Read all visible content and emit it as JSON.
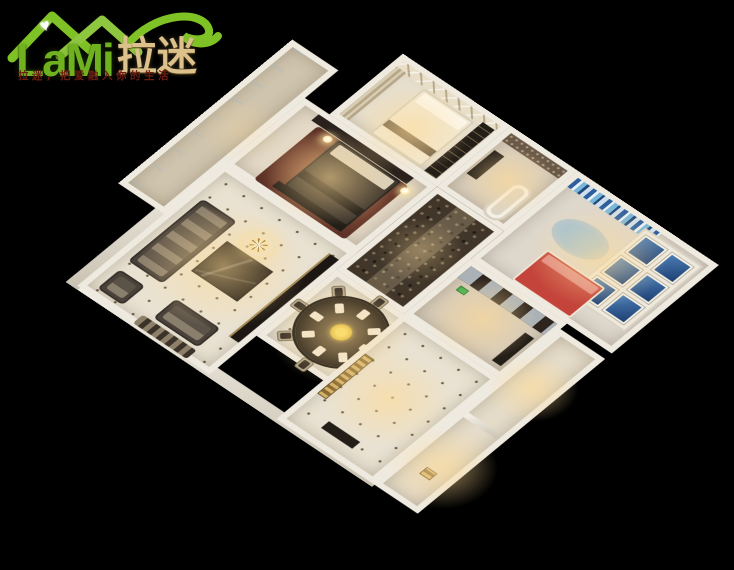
{
  "page": {
    "background_color": "#000000",
    "width": 734,
    "height": 570
  },
  "logo": {
    "brand_latin": "LaMi",
    "brand_cn": "拉迷",
    "tagline": "拉迷，把爱融入你的生活",
    "colors": {
      "roof_green": "#7fc226",
      "brand_green": "#6fb11e",
      "brand_gold": "#dcc18c",
      "tagline_red": "#6e1d14"
    }
  },
  "icons": {
    "heart": "♥"
  },
  "scene": {
    "description": "3D cutaway floor-plan render of a furnished apartment viewed from above on a black background",
    "rooms": [
      "guest-bedroom",
      "master-bedroom",
      "living-room",
      "balcony",
      "bathroom",
      "kids-bedroom",
      "hallway",
      "dining-room",
      "kitchen",
      "foyer",
      "utility-rooms"
    ],
    "palette": {
      "floor_cream": "#e9e2d2",
      "wall_white": "#efeae0",
      "wood_dark": "#241e18",
      "mosaic_brown": "#42372b",
      "accent_blue": "#2f5f96",
      "accent_red": "#c4433a",
      "flower_yellow": "#e6c51d",
      "glow_warm": "#ffd98c"
    }
  }
}
